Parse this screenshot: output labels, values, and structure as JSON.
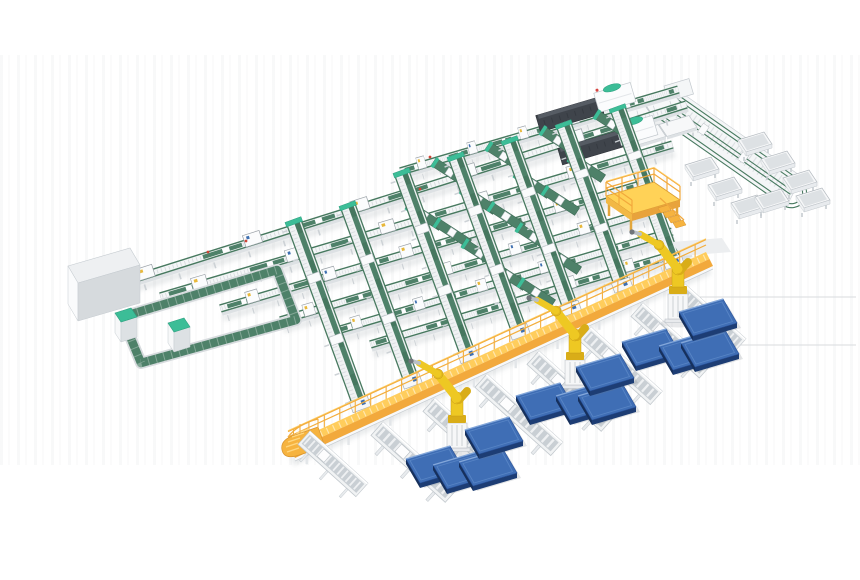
{
  "meta": {
    "kind": "3d-isometric-render",
    "subject": "automated-sortation-and-palletizing-line"
  },
  "palette": {
    "belt_green": "#4e8169",
    "rail_green": "#47795f",
    "teal_accent": "#3cbd97",
    "frame_light": "#f1f3f4",
    "frame_mid": "#d9dde0",
    "frame_dark": "#b9bfc5",
    "walkway_yellow": "#ffcd5c",
    "walkway_orange": "#f2a93c",
    "mezzanine_yellow": "#ffd257",
    "robot_yellow": "#eec823",
    "pallet_blue": "#3f6eb5",
    "pallet_blue_dark": "#1d3d74",
    "machine_dark": "#3f444b",
    "background": "#ffffff"
  },
  "scene": {
    "canvas": {
      "w": 860,
      "h": 580
    },
    "floor_lines": [
      {
        "x1": 700,
        "y1": 297,
        "x2": 856,
        "y2": 297
      },
      {
        "x1": 676,
        "y1": 345,
        "x2": 856,
        "y2": 345
      }
    ],
    "main_lines": [
      {
        "x1": 400,
        "y1": 170,
        "x2": 678,
        "y2": 88
      },
      {
        "x1": 100,
        "y1": 288,
        "x2": 686,
        "y2": 103
      },
      {
        "x1": 160,
        "y1": 295,
        "x2": 672,
        "y2": 143
      },
      {
        "x1": 220,
        "y1": 307,
        "x2": 640,
        "y2": 183
      },
      {
        "x1": 280,
        "y1": 319,
        "x2": 655,
        "y2": 208
      },
      {
        "x1": 330,
        "y1": 331,
        "x2": 672,
        "y2": 230
      },
      {
        "x1": 370,
        "y1": 343,
        "x2": 690,
        "y2": 248
      }
    ],
    "chutes": [
      {
        "x": 300,
        "y": 217,
        "len": 202
      },
      {
        "x": 354,
        "y": 201,
        "len": 194
      },
      {
        "x": 408,
        "y": 168,
        "len": 202
      },
      {
        "x": 462,
        "y": 152,
        "len": 194
      },
      {
        "x": 516,
        "y": 136,
        "len": 186
      },
      {
        "x": 570,
        "y": 120,
        "len": 178
      },
      {
        "x": 624,
        "y": 104,
        "len": 170
      }
    ],
    "merge_belts": [
      [
        436,
        158
      ],
      [
        490,
        142
      ],
      [
        544,
        126
      ],
      [
        598,
        110
      ],
      [
        410,
        201
      ],
      [
        464,
        185
      ],
      [
        518,
        169
      ],
      [
        572,
        153
      ],
      [
        438,
        218
      ],
      [
        492,
        202
      ],
      [
        546,
        186
      ],
      [
        466,
        239
      ],
      [
        520,
        223
      ],
      [
        494,
        261
      ],
      [
        548,
        245
      ],
      [
        522,
        278
      ]
    ],
    "spurs": [
      {
        "x": 310,
        "y": 431,
        "len": 78
      },
      {
        "x": 383,
        "y": 422,
        "len": 100
      },
      {
        "x": 435,
        "y": 398,
        "len": 102
      },
      {
        "x": 487,
        "y": 374,
        "len": 102
      },
      {
        "x": 539,
        "y": 351,
        "len": 100
      },
      {
        "x": 591,
        "y": 327,
        "len": 96
      },
      {
        "x": 643,
        "y": 303,
        "len": 92
      },
      {
        "x": 685,
        "y": 284,
        "len": 82
      }
    ],
    "machines": [
      {
        "x": 540,
        "y": 130
      },
      {
        "x": 562,
        "y": 163
      }
    ],
    "robots": [
      [
        457,
        451
      ],
      [
        575,
        388
      ],
      [
        678,
        322
      ]
    ],
    "pallets": [
      [
        435,
        467
      ],
      [
        462,
        473
      ],
      [
        488,
        470
      ],
      [
        494,
        438
      ],
      [
        545,
        404
      ],
      [
        585,
        404
      ],
      [
        607,
        404
      ],
      [
        605,
        375
      ],
      [
        651,
        350
      ],
      [
        688,
        354
      ],
      [
        710,
        351
      ],
      [
        708,
        320
      ]
    ],
    "bins": [
      [
        702,
        167
      ],
      [
        725,
        187
      ],
      [
        748,
        205
      ],
      [
        755,
        142
      ],
      [
        778,
        161
      ],
      [
        800,
        180
      ],
      [
        772,
        199
      ],
      [
        813,
        198
      ]
    ],
    "tables": [
      [
        632,
        113
      ],
      [
        663,
        104
      ],
      [
        647,
        135
      ],
      [
        678,
        126
      ]
    ],
    "cabinets": [
      [
        115,
        313
      ],
      [
        168,
        323
      ]
    ],
    "red_dots": [
      [
        208,
        252
      ],
      [
        246,
        241
      ],
      [
        352,
        209
      ],
      [
        300,
        250
      ],
      [
        420,
        189
      ],
      [
        430,
        157
      ]
    ],
    "walkway": {
      "x1": 288,
      "y1": 444,
      "x2": 706,
      "y2": 252,
      "rail_height": 12,
      "post_spacing": 17,
      "support_spacing": 46
    },
    "mezzanine": {
      "x": 606,
      "y": 196
    },
    "white_box": {
      "x": 68,
      "y": 248
    },
    "ring": {
      "x": 122,
      "y": 317
    }
  }
}
